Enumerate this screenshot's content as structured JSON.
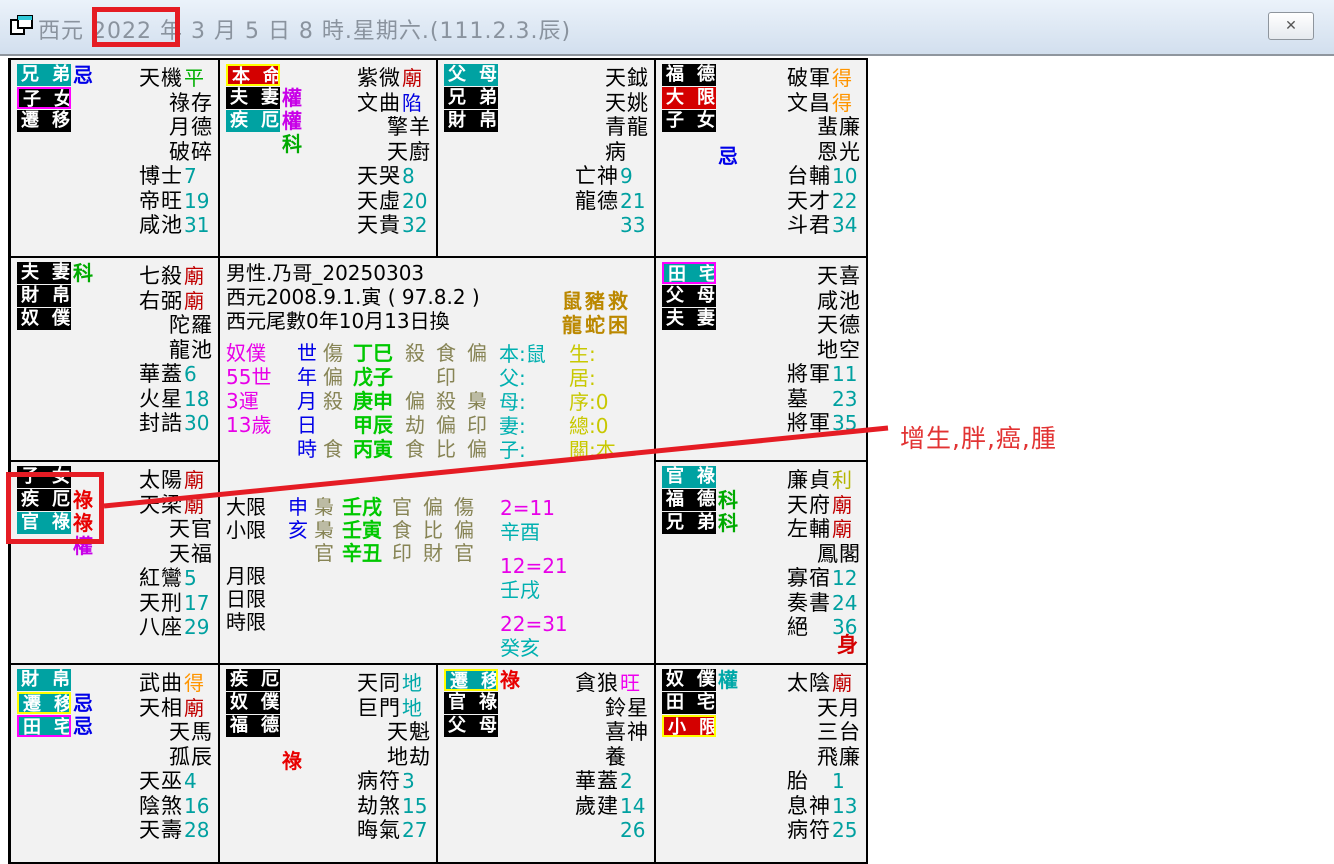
{
  "window": {
    "title": "西元 2022 年 3 月 5 日 8 時.星期六.(111.2.3.辰)",
    "close_icon": "✕"
  },
  "annotation": {
    "text": "增生,胖,癌,腫"
  },
  "colors": {
    "teal_bg": "#00a2a2",
    "black_bg": "#000000",
    "red_bg": "#d40000",
    "magenta_border": "#ff00ff",
    "yellow_border": "#ffff00",
    "num": "#00a0a0",
    "miao": "#c00000",
    "xian": "#0000e0",
    "de": "#ff9500",
    "ping": "#00b000",
    "li": "#b4b400",
    "wang": "#f000f0",
    "di": "#00a8a8",
    "hua_ji": "#0000e8",
    "hua_lu": "#e80000",
    "hua_quan": "#c800e8",
    "hua_ke": "#00aa00",
    "hua_quan_teal": "#00a8a8",
    "annotation_red": "#e51c24",
    "body_red": "#d40000",
    "center_magenta": "#e800e8",
    "center_blue": "#0000e8",
    "center_olive": "#878455",
    "center_green": "#00c800",
    "center_teal": "#00b0b0",
    "center_yellow": "#c8c800",
    "center_gold": "#bb8800"
  },
  "palaces": [
    {
      "labels": [
        {
          "text": "兄弟",
          "bg": "teal"
        },
        {
          "text": "子女",
          "bg": "black",
          "border": "magenta"
        },
        {
          "text": "遷移",
          "bg": "black"
        }
      ],
      "hua": [
        {
          "t": "忌",
          "c": "hua_ji",
          "r": 0
        }
      ],
      "stars": [
        {
          "n": "天機",
          "s": "平",
          "k": "ping"
        },
        {
          "n": "祿存"
        },
        {
          "n": "月德"
        },
        {
          "n": "破碎"
        },
        {
          "n": "博士",
          "s": "7",
          "k": "num"
        },
        {
          "n": "帝旺",
          "s": "19",
          "k": "num"
        },
        {
          "n": "咸池",
          "s": "31",
          "k": "num"
        }
      ]
    },
    {
      "labels": [
        {
          "text": "本命",
          "bg": "red",
          "border": "yellow"
        },
        {
          "text": "夫妻",
          "bg": "black"
        },
        {
          "text": "疾厄",
          "bg": "teal"
        }
      ],
      "hua": [
        {
          "t": "權",
          "c": "hua_quan",
          "r": 1
        },
        {
          "t": "權",
          "c": "hua_quan",
          "r": 2
        },
        {
          "t": "科",
          "c": "hua_ke",
          "r": 3
        }
      ],
      "stars": [
        {
          "n": "紫微",
          "s": "廟",
          "k": "miao"
        },
        {
          "n": "文曲",
          "s": "陷",
          "k": "xian"
        },
        {
          "n": "擎羊"
        },
        {
          "n": "天廚"
        },
        {
          "n": "天哭",
          "s": "8",
          "k": "num"
        },
        {
          "n": "天虛",
          "s": "20",
          "k": "num"
        },
        {
          "n": "天貴",
          "s": "32",
          "k": "num"
        }
      ]
    },
    {
      "labels": [
        {
          "text": "父母",
          "bg": "teal"
        },
        {
          "text": "兄弟",
          "bg": "black"
        },
        {
          "text": "財帛",
          "bg": "black"
        }
      ],
      "hua": [],
      "stars": [
        {
          "n": "天鉞"
        },
        {
          "n": "天姚"
        },
        {
          "n": "青龍"
        },
        {
          "n": "病"
        },
        {
          "n": "亡神",
          "s": "9",
          "k": "num"
        },
        {
          "n": "龍德",
          "s": "21",
          "k": "num"
        },
        {
          "n": "",
          "s": "33",
          "k": "num"
        }
      ]
    },
    {
      "labels": [
        {
          "text": "福德",
          "bg": "black"
        },
        {
          "text": "大限",
          "bg": "red"
        },
        {
          "text": "子女",
          "bg": "black"
        }
      ],
      "hua": [
        {
          "t": "忌",
          "c": "hua_ji",
          "r": 3.5
        }
      ],
      "stars": [
        {
          "n": "破軍",
          "s": "得",
          "k": "de"
        },
        {
          "n": "文昌",
          "s": "得",
          "k": "de"
        },
        {
          "n": "蜚廉"
        },
        {
          "n": "恩光"
        },
        {
          "n": "台輔",
          "s": "10",
          "k": "num"
        },
        {
          "n": "天才",
          "s": "22",
          "k": "num"
        },
        {
          "n": "斗君",
          "s": "34",
          "k": "num"
        }
      ]
    },
    {
      "labels": [
        {
          "text": "夫妻",
          "bg": "black"
        },
        {
          "text": "財帛",
          "bg": "black"
        },
        {
          "text": "奴僕",
          "bg": "black"
        }
      ],
      "hua": [
        {
          "t": "科",
          "c": "hua_ke",
          "r": 0
        }
      ],
      "stars": [
        {
          "n": "七殺",
          "s": "廟",
          "k": "miao"
        },
        {
          "n": "右弼",
          "s": "廟",
          "k": "miao"
        },
        {
          "n": "陀羅"
        },
        {
          "n": "龍池"
        },
        {
          "n": "華蓋",
          "s": "6",
          "k": "num"
        },
        {
          "n": "火星",
          "s": "18",
          "k": "num"
        },
        {
          "n": "封誥",
          "s": "30",
          "k": "num"
        }
      ]
    },
    {
      "labels": [
        {
          "text": "田宅",
          "bg": "teal",
          "border": "magenta"
        },
        {
          "text": "父母",
          "bg": "black"
        },
        {
          "text": "夫妻",
          "bg": "black"
        }
      ],
      "hua": [],
      "stars": [
        {
          "n": "天喜"
        },
        {
          "n": "咸池"
        },
        {
          "n": "天德"
        },
        {
          "n": "地空"
        },
        {
          "n": "將軍",
          "s": "11",
          "k": "num"
        },
        {
          "n": "墓",
          "s": "23",
          "k": "num"
        },
        {
          "n": "將軍",
          "s": "35",
          "k": "num"
        }
      ]
    },
    {
      "labels": [
        {
          "text": "子女",
          "bg": "black"
        },
        {
          "text": "疾厄",
          "bg": "black"
        },
        {
          "text": "官祿",
          "bg": "teal"
        }
      ],
      "hua": [
        {
          "t": "祿",
          "c": "hua_lu",
          "r": 1
        },
        {
          "t": "祿",
          "c": "hua_lu",
          "r": 2
        },
        {
          "t": "權",
          "c": "hua_quan",
          "r": 3
        }
      ],
      "stars": [
        {
          "n": "太陽",
          "s": "廟",
          "k": "miao"
        },
        {
          "n": "天梁",
          "s": "廟",
          "k": "miao"
        },
        {
          "n": "天官"
        },
        {
          "n": "天福"
        },
        {
          "n": "紅鸞",
          "s": "5",
          "k": "num"
        },
        {
          "n": "天刑",
          "s": "17",
          "k": "num"
        },
        {
          "n": "八座",
          "s": "29",
          "k": "num"
        }
      ]
    },
    {
      "labels": [
        {
          "text": "官祿",
          "bg": "teal"
        },
        {
          "text": "福德",
          "bg": "black"
        },
        {
          "text": "兄弟",
          "bg": "black"
        }
      ],
      "hua": [
        {
          "t": "科",
          "c": "hua_ke",
          "r": 1
        },
        {
          "t": "科",
          "c": "hua_ke",
          "r": 2
        }
      ],
      "body_mark": "身",
      "stars": [
        {
          "n": "廉貞",
          "s": "利",
          "k": "li"
        },
        {
          "n": "天府",
          "s": "廟",
          "k": "miao"
        },
        {
          "n": "左輔",
          "s": "廟",
          "k": "miao"
        },
        {
          "n": "鳳閣"
        },
        {
          "n": "寡宿",
          "s": "12",
          "k": "num"
        },
        {
          "n": "奏書",
          "s": "24",
          "k": "num"
        },
        {
          "n": "絕",
          "s": "36",
          "k": "num"
        }
      ]
    },
    {
      "labels": [
        {
          "text": "財帛",
          "bg": "teal"
        },
        {
          "text": "遷移",
          "bg": "teal",
          "border": "yellow"
        },
        {
          "text": "田宅",
          "bg": "teal",
          "border": "magenta"
        }
      ],
      "hua": [
        {
          "t": "忌",
          "c": "hua_ji",
          "r": 1
        },
        {
          "t": "忌",
          "c": "hua_ji",
          "r": 2
        }
      ],
      "stars": [
        {
          "n": "武曲",
          "s": "得",
          "k": "de"
        },
        {
          "n": "天相",
          "s": "廟",
          "k": "miao"
        },
        {
          "n": "天馬"
        },
        {
          "n": "孤辰"
        },
        {
          "n": "天巫",
          "s": "4",
          "k": "num"
        },
        {
          "n": "陰煞",
          "s": "16",
          "k": "num"
        },
        {
          "n": "天壽",
          "s": "28",
          "k": "num"
        }
      ]
    },
    {
      "labels": [
        {
          "text": "疾厄",
          "bg": "black"
        },
        {
          "text": "奴僕",
          "bg": "black"
        },
        {
          "text": "福德",
          "bg": "black"
        }
      ],
      "hua": [
        {
          "t": "祿",
          "c": "hua_lu",
          "r": 3.5
        }
      ],
      "stars": [
        {
          "n": "天同",
          "s": "地",
          "k": "di"
        },
        {
          "n": "巨門",
          "s": "地",
          "k": "di"
        },
        {
          "n": "天魁"
        },
        {
          "n": "地劫"
        },
        {
          "n": "病符",
          "s": "3",
          "k": "num"
        },
        {
          "n": "劫煞",
          "s": "15",
          "k": "num"
        },
        {
          "n": "晦氣",
          "s": "27",
          "k": "num"
        }
      ]
    },
    {
      "labels": [
        {
          "text": "遷移",
          "bg": "teal",
          "border": "yellow"
        },
        {
          "text": "官祿",
          "bg": "black"
        },
        {
          "text": "父母",
          "bg": "black"
        }
      ],
      "hua": [
        {
          "t": "祿",
          "c": "hua_lu",
          "r": 0
        }
      ],
      "stars": [
        {
          "n": "貪狼",
          "s": "旺",
          "k": "wang"
        },
        {
          "n": "鈴星"
        },
        {
          "n": "喜神"
        },
        {
          "n": "養"
        },
        {
          "n": "華蓋",
          "s": "2",
          "k": "num"
        },
        {
          "n": "歲建",
          "s": "14",
          "k": "num"
        },
        {
          "n": "",
          "s": "26",
          "k": "num"
        }
      ]
    },
    {
      "labels": [
        {
          "text": "奴僕",
          "bg": "black"
        },
        {
          "text": "田宅",
          "bg": "black"
        },
        {
          "text": "小限",
          "bg": "red",
          "border": "yellow"
        }
      ],
      "hua": [
        {
          "t": "權",
          "c": "hua_quan_teal",
          "r": 0
        }
      ],
      "stars": [
        {
          "n": "太陰",
          "s": "廟",
          "k": "miao"
        },
        {
          "n": "天月"
        },
        {
          "n": "三台"
        },
        {
          "n": "飛廉"
        },
        {
          "n": "胎",
          "s": "1",
          "k": "num"
        },
        {
          "n": "息神",
          "s": "13",
          "k": "num"
        },
        {
          "n": "病符",
          "s": "25",
          "k": "num"
        }
      ]
    }
  ],
  "center": {
    "info_lines": [
      "男性.乃哥_20250303",
      "西元2008.9.1.寅 ( 97.8.2 )",
      "西元尾數0年10月13日換"
    ],
    "pillars": {
      "col1": [
        "奴僕",
        "55世",
        "3運",
        "13歲",
        ""
      ],
      "rows": [
        {
          "cycle": "世",
          "god": "傷",
          "pillar": "丁巳",
          "gods": [
            "殺",
            "食",
            "偏"
          ]
        },
        {
          "cycle": "年",
          "god": "偏",
          "pillar": "戊子",
          "gods": [
            "",
            "印",
            ""
          ]
        },
        {
          "cycle": "月",
          "god": "殺",
          "pillar": "庚申",
          "gods": [
            "偏",
            "殺",
            "梟"
          ]
        },
        {
          "cycle": "日",
          "god": "",
          "pillar": "甲辰",
          "gods": [
            "劫",
            "偏",
            "印"
          ]
        },
        {
          "cycle": "時",
          "god": "食",
          "pillar": "丙寅",
          "gods": [
            "食",
            "比",
            "偏"
          ]
        }
      ]
    },
    "fate_note": [
      "鼠豬救",
      "龍蛇困"
    ],
    "family": [
      "本:鼠",
      "父:",
      "母:",
      "妻:",
      "子:"
    ],
    "status": [
      "生:",
      "居:",
      "序:0",
      "總:0",
      "關:本"
    ],
    "limits": [
      {
        "label": "大限",
        "branch": "申",
        "god": "梟",
        "pillar": "壬戌",
        "gods": [
          "官",
          "偏",
          "傷"
        ]
      },
      {
        "label": "小限",
        "branch": "亥",
        "god": "梟",
        "pillar": "壬寅",
        "gods": [
          "食",
          "比",
          "偏"
        ]
      },
      {
        "label": "",
        "branch": "",
        "god": "官",
        "pillar": "辛丑",
        "gods": [
          "印",
          "財",
          "官"
        ]
      },
      {
        "label": "月限",
        "branch": "",
        "god": "",
        "pillar": "",
        "gods": []
      },
      {
        "label": "日限",
        "branch": "",
        "god": "",
        "pillar": "",
        "gods": []
      },
      {
        "label": "時限",
        "branch": "",
        "god": "",
        "pillar": "",
        "gods": []
      }
    ],
    "decades": [
      {
        "range": "2=11",
        "pillar": "辛酉"
      },
      {
        "range": "12=21",
        "pillar": "壬戌"
      },
      {
        "range": "22=31",
        "pillar": "癸亥"
      }
    ]
  }
}
